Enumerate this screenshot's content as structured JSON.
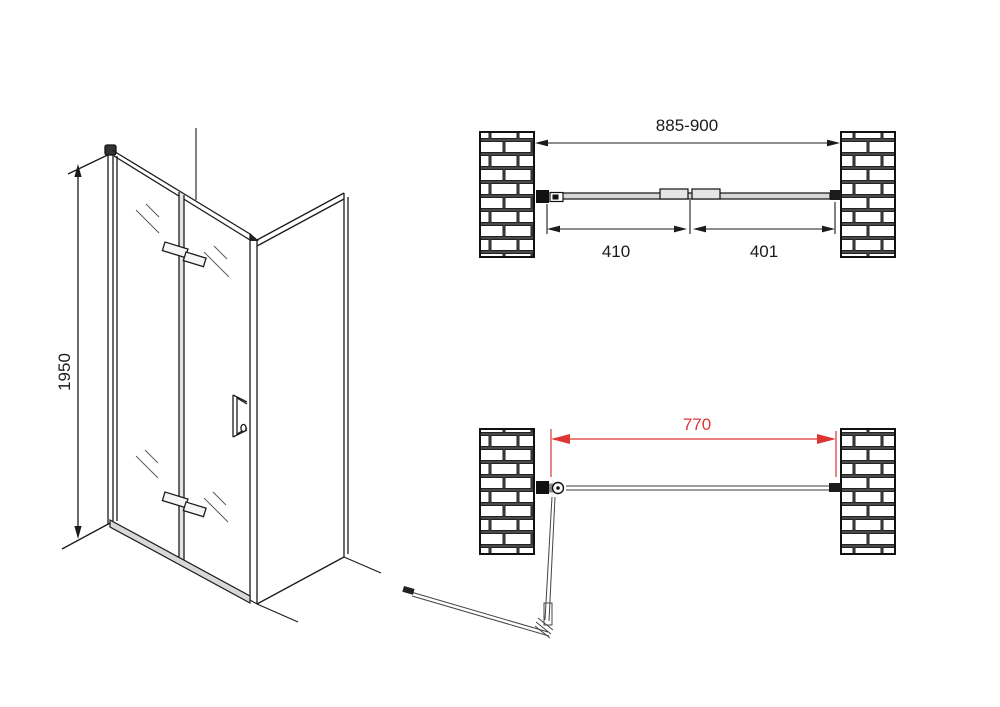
{
  "drawing": {
    "type": "shower-folding-door-technical-drawing",
    "colors": {
      "line": "#1b1b1b",
      "glass_line": "#555555",
      "accent_red": "#dd3434",
      "brick_mortar": "#4a4a4a",
      "brick_face": "#ffffff"
    },
    "iso_view": {
      "height_dimension": "1950"
    },
    "plan_closed": {
      "overall_width_dimension": "885-900",
      "left_panel_dimension": "410",
      "right_panel_dimension": "401"
    },
    "plan_open": {
      "clear_opening_dimension": "770"
    }
  }
}
